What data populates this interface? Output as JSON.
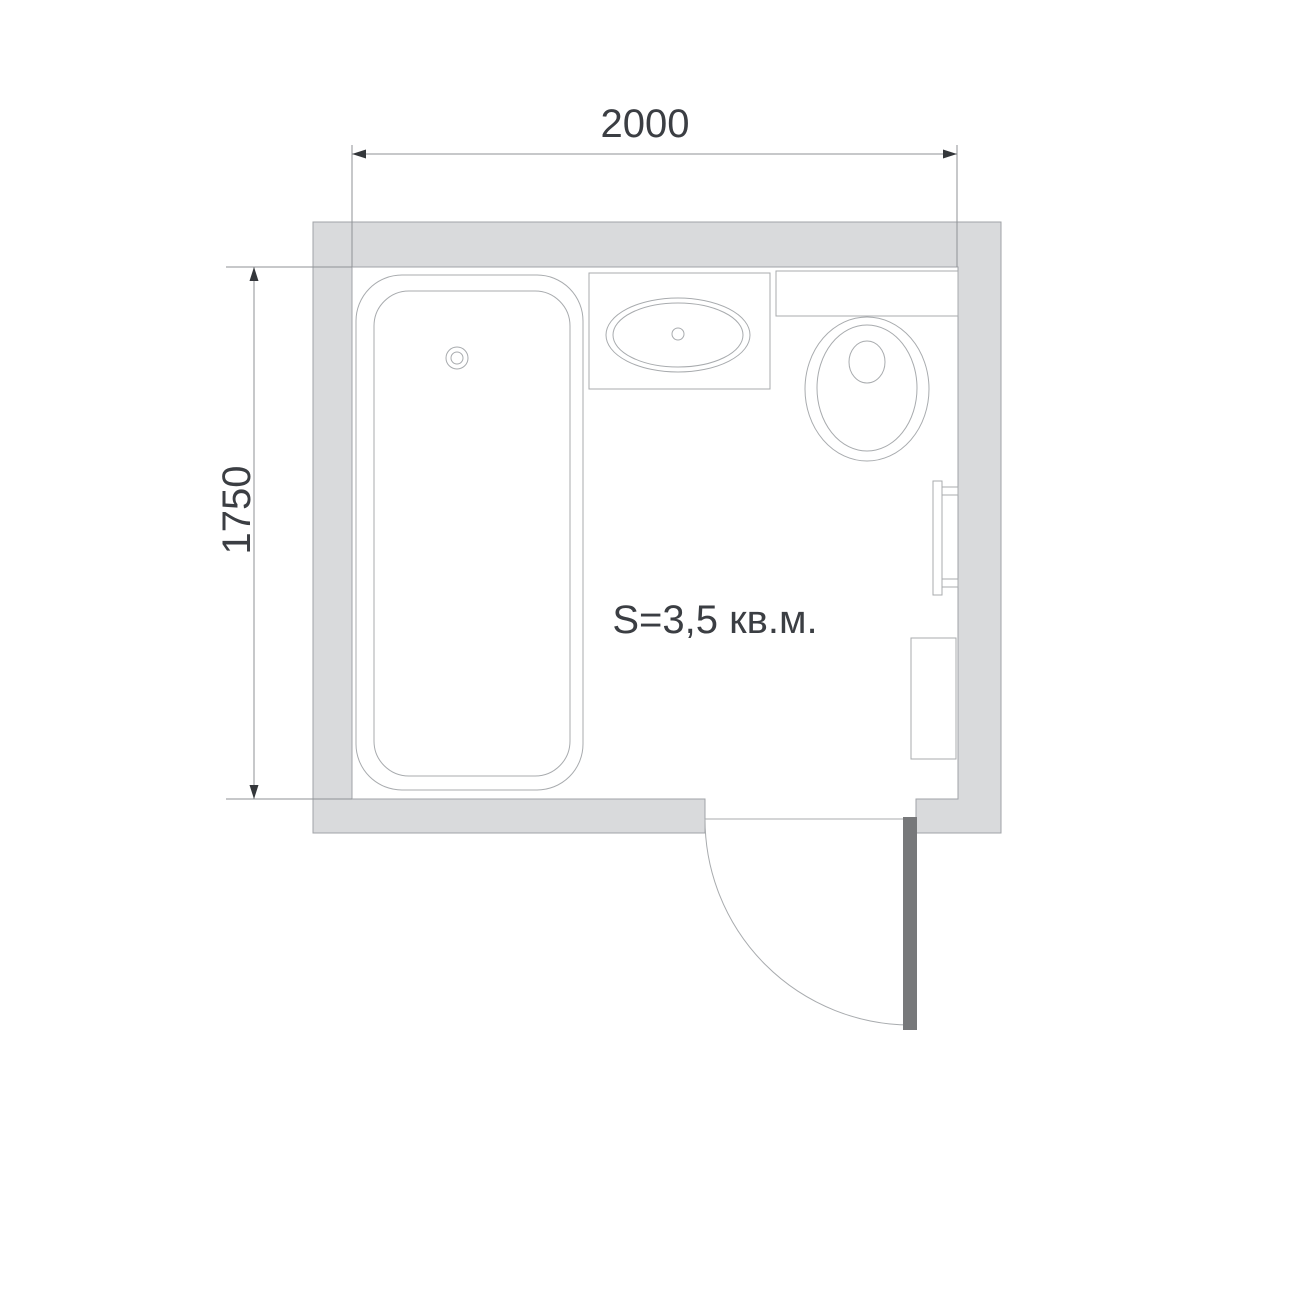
{
  "drawing": {
    "type": "bathroom-floor-plan"
  },
  "dimensions": {
    "width_label": "2000",
    "height_label": "1750"
  },
  "room": {
    "area_label": "S=3,5 кв.м."
  },
  "fixtures": [
    "bathtub-icon",
    "sink-vanity-icon",
    "toilet-icon",
    "towel-rail-icon",
    "cabinet-icon",
    "door-icon"
  ],
  "colors": {
    "page_bg": "#ffffff",
    "wall_fill": "#d9dadc",
    "wall_outline": "#a0a3a7",
    "fixture_fill": "#ffffff",
    "fixture_outline": "#a8abae",
    "dim_line": "#8f9296",
    "dim_arrow": "#34373b",
    "text_color": "#3b3e43",
    "door_leaf": "#77787a"
  }
}
